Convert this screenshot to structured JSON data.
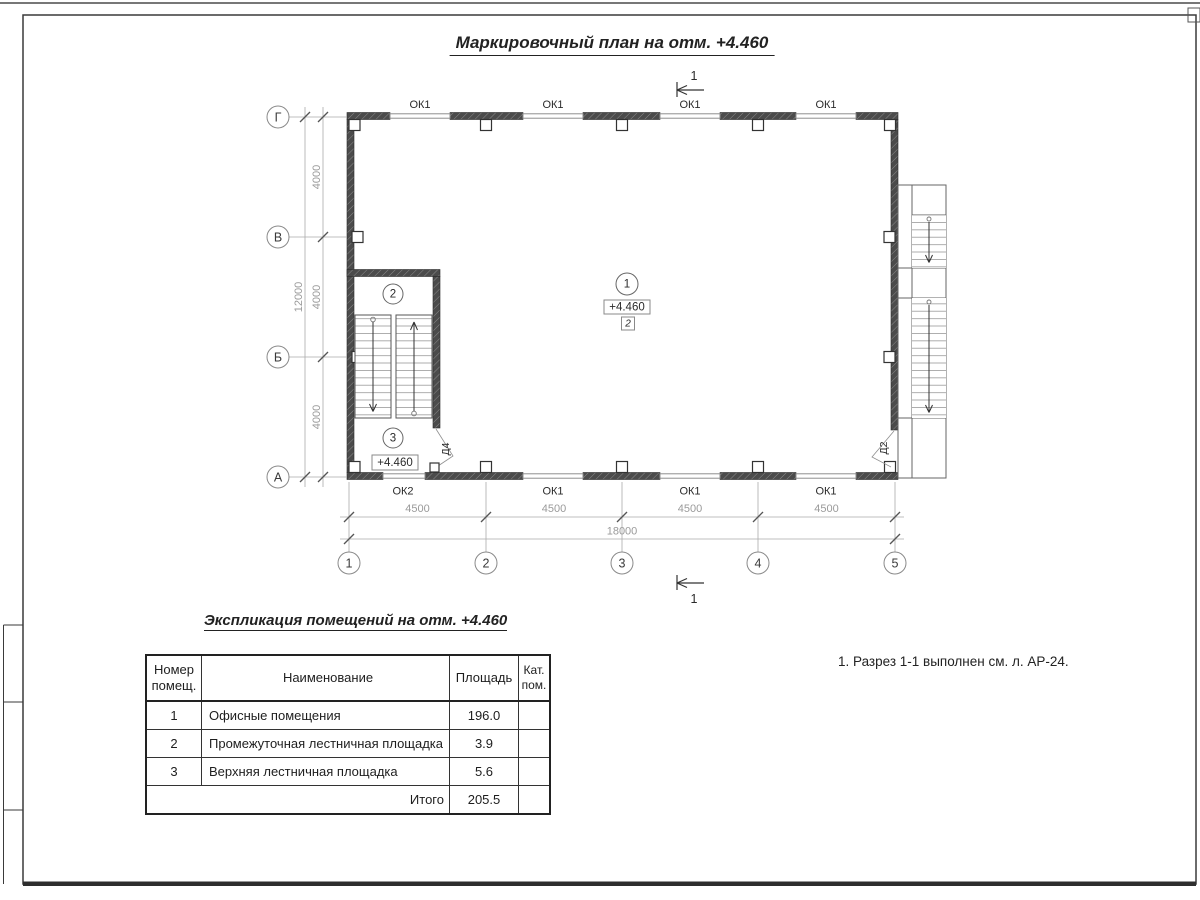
{
  "sheet": {
    "title": "Маркировочный план на отм. +4.460",
    "note": "1. Разрез 1-1 выполнен см. л. АР-24."
  },
  "plan": {
    "section_label": "1",
    "axes_rows": [
      "Г",
      "В",
      "Б",
      "А"
    ],
    "axes_cols": [
      "1",
      "2",
      "3",
      "4",
      "5"
    ],
    "dims_left": [
      "4000",
      "4000",
      "4000"
    ],
    "dim_left_total": "12000",
    "dims_bottom": [
      "4500",
      "4500",
      "4500",
      "4500"
    ],
    "dim_bottom_total": "18000",
    "windows_top": [
      "ОК1",
      "ОК1",
      "ОК1",
      "ОК1"
    ],
    "windows_bottom": [
      "ОК2",
      "ОК1",
      "ОК1",
      "ОК1"
    ],
    "door_labels": [
      "Д4",
      "Д2"
    ],
    "rooms": [
      {
        "num": "1",
        "elevation": "+4.460",
        "floor_type": "2"
      },
      {
        "num": "2"
      },
      {
        "num": "3",
        "elevation": "+4.460"
      }
    ]
  },
  "schedule": {
    "title": "Экспликация помещений на отм. +4.460",
    "headers": [
      "Номер\nпомещ.",
      "Наименование",
      "Площадь",
      "Кат.\nпом."
    ],
    "rows": [
      [
        "1",
        "Офисные помещения",
        "196.0"
      ],
      [
        "2",
        "Промежуточная лестничная площадка",
        "3.9"
      ],
      [
        "3",
        "Верхняя лестничная площадка",
        "5.6"
      ]
    ],
    "total_label": "Итого",
    "total_value": "205.5"
  },
  "colors": {
    "wall_fill": "#4b4b4b",
    "line": "#333333",
    "dim_text": "#999999"
  }
}
